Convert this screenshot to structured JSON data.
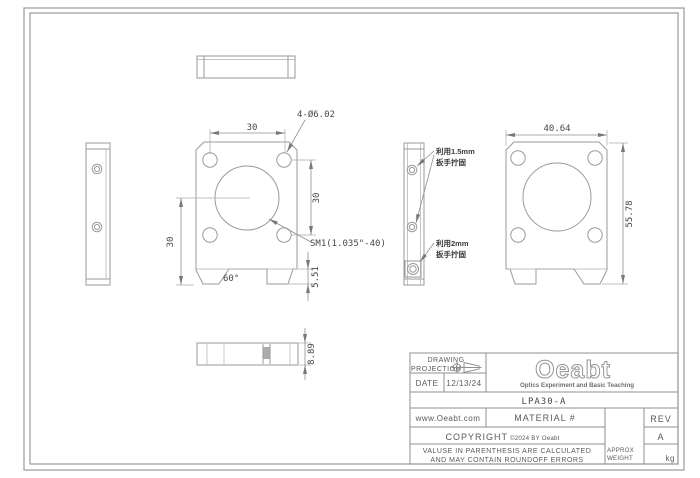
{
  "colors": {
    "drawing_line": "#9a9a9a",
    "dimension_text": "#474747",
    "title_text": "#5a5a5a",
    "background": "#ffffff"
  },
  "front_view": {
    "dim_width": "30",
    "dim_height_right": "30",
    "dim_height_left": "30",
    "hole_callout": "4-Ø6.02",
    "thread_callout": "SM1(1.035\"-40)",
    "angle_label": "60°",
    "notch_depth": "5.51"
  },
  "back_view": {
    "dim_width": "40.64",
    "dim_height": "55.78"
  },
  "bottom_view": {
    "dim_thickness": "8.89"
  },
  "side_notes": {
    "wrench15_line1": "利用1.5mm",
    "wrench15_line2": "扳手拧固",
    "wrench2_line1": "利用2mm",
    "wrench2_line2": "扳手拧固"
  },
  "title_block": {
    "drawing_label": "DRAWING",
    "projection_label": "PROJECTION",
    "date_label": "DATE",
    "date_value": "12/13/24",
    "logo": "Oeabt",
    "tagline": "Optics Experiment and Basic Teaching",
    "part_number": "LPA30-A",
    "website": "www.Oeabt.com",
    "material_label": "MATERIAL #",
    "rev_label": "REV",
    "copyright_label": "COPYRIGHT",
    "copyright_detail": "©2024 BY Oeabt",
    "rev_value": "A",
    "disclaimer_line1": "VALUSE IN PARENTHESIS ARE CALCULATED",
    "disclaimer_line2": "AND MAY CONTAIN ROUNDOFF ERRORS",
    "approx_label": "APPROX",
    "weight_label": "WEIGHT",
    "weight_unit": "kg"
  }
}
